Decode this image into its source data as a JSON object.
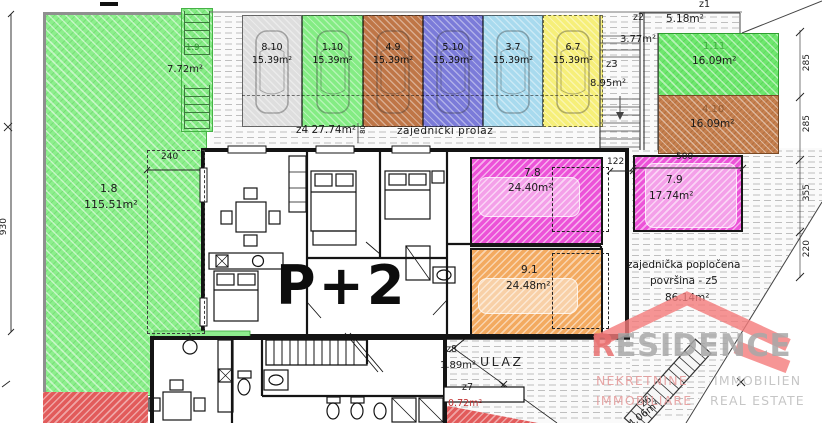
{
  "labels": {
    "p2": "P+2",
    "ulaz": "ULAZ",
    "prolaz": "zajednički prolaz",
    "z4": "z4  27.74m²",
    "z4_dim": "80"
  },
  "zones": {
    "z1": {
      "id": "z1",
      "area": "5.18m²"
    },
    "z2": {
      "id": "z2",
      "area": "3.77m²"
    },
    "z3": {
      "id": "z3",
      "area": "8.95m²"
    },
    "z5": {
      "line1": "zajednička popločena",
      "line2": "površina - z5",
      "area": "86.14m²"
    },
    "z6": {
      "id": "z6",
      "area": "4.06m²"
    },
    "z7": {
      "id": "z7",
      "area": "0.72m²"
    },
    "z8": {
      "id": "z8",
      "area": "1.89m²"
    }
  },
  "areas": {
    "garden": {
      "id": "1.8",
      "area": "115.51m²",
      "color": "#8cef8c"
    },
    "stair_strip": {
      "id": "1.9",
      "area": "7.72m²",
      "color": "#86ec86"
    },
    "plot_1_11": {
      "id": "1.11",
      "area": "16.09m²",
      "color": "#6ee76e"
    },
    "plot_4_10": {
      "id": "4.10",
      "area": "16.09m²",
      "color": "#c6804f"
    },
    "terrace_7_8": {
      "id": "7.8",
      "area": "24.40m²",
      "color": "#ec52d8"
    },
    "terrace_7_9": {
      "id": "7.9",
      "area": "17.74m²",
      "color": "#ec52d8"
    },
    "terrace_9_1": {
      "id": "9.1",
      "area": "24.48m²",
      "color": "#f3aa60"
    }
  },
  "colors": {
    "red_hatch": "#e25b5b"
  },
  "parking": {
    "stalls": [
      {
        "id": "8.10",
        "area": "15.39m²",
        "color": "#dedede"
      },
      {
        "id": "1.10",
        "area": "15.39m²",
        "color": "#84ec84"
      },
      {
        "id": "4.9",
        "area": "15.39m²",
        "color": "#bf7647"
      },
      {
        "id": "5.10",
        "area": "15.39m²",
        "color": "#7b7bd9"
      },
      {
        "id": "3.7",
        "area": "15.39m²",
        "color": "#a8daee"
      },
      {
        "id": "6.7",
        "area": "15.39m²",
        "color": "#f6ef79"
      }
    ]
  },
  "dimensions": {
    "left_height": "930",
    "garden_width": "240",
    "terrace_gap": "122",
    "terrace79_width": "500",
    "right_chain": [
      "285",
      "285",
      "355",
      "220"
    ]
  },
  "logo": {
    "brand_first": "R",
    "brand_rest": "ESIDENCE",
    "red": "#e87070",
    "gray": "#a8a8a8",
    "tag_row1_left": "NEKRETNINE",
    "tag_row1_right": "IMMOBILIEN",
    "tag_row2_left": "IMMOBILIARE",
    "tag_row2_right": "REAL ESTATE"
  }
}
